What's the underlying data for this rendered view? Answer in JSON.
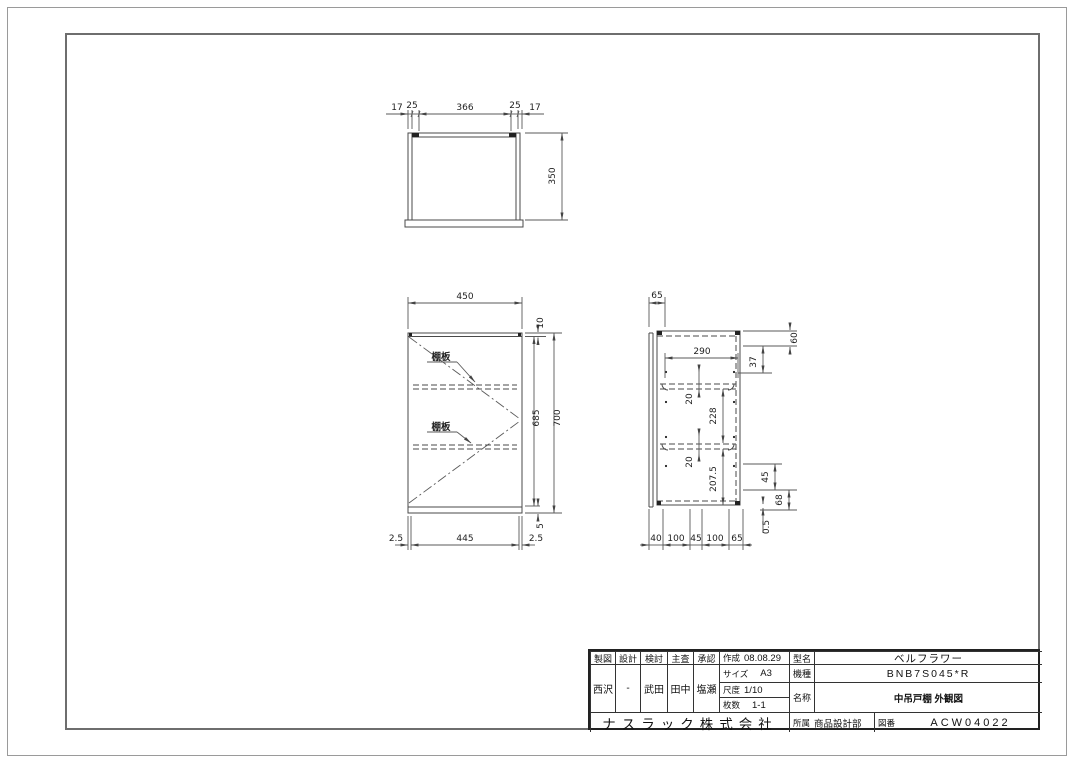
{
  "drawing": {
    "top_view": {
      "dims_top": [
        "17",
        "25",
        "366",
        "25",
        "17"
      ],
      "dim_depth": "350"
    },
    "front_view": {
      "dim_width": "450",
      "dim_top": "10",
      "dim_body_height": "685",
      "dim_total_height": "700",
      "dim_bottom_panel": "5",
      "dims_bottom": [
        "2.5",
        "445",
        "2.5"
      ],
      "shelf_label": "棚板"
    },
    "side_view": {
      "dim_top": "65",
      "dim_inner_width": "290",
      "dim_right_1": "60",
      "dim_right_2": "37",
      "dim_pin_upper": "20",
      "dim_shelf_gap": "228",
      "dim_pin_lower": "20",
      "dim_lower_height": "207.5",
      "dim_right_3": "45",
      "dim_right_4": "68",
      "dim_right_5": "0.5",
      "dims_bottom": [
        "40",
        "100",
        "45",
        "100",
        "65"
      ]
    }
  },
  "title_block": {
    "headers": [
      "製図",
      "設計",
      "検討",
      "主査",
      "承認"
    ],
    "signatures": [
      "西沢",
      "-",
      "武田",
      "田中",
      "塩瀬"
    ],
    "created_label": "作成",
    "created_value": "08.08.29",
    "size_label": "サイズ",
    "size_value": "A3",
    "scale_label": "尺度",
    "scale_value": "1/10",
    "sheets_label": "枚数",
    "sheets_value": "1-1",
    "model_label": "型名",
    "model_value": "ベルフラワー",
    "type_label": "機種",
    "type_value": "BNB7S045*R",
    "name_label": "名称",
    "name_value": "中吊戸棚 外観図",
    "company": "ナスラック株式会社",
    "dept_label": "所属",
    "dept_value": "商品設計部",
    "dwg_label": "図番",
    "dwg_value": "ACW04022"
  }
}
